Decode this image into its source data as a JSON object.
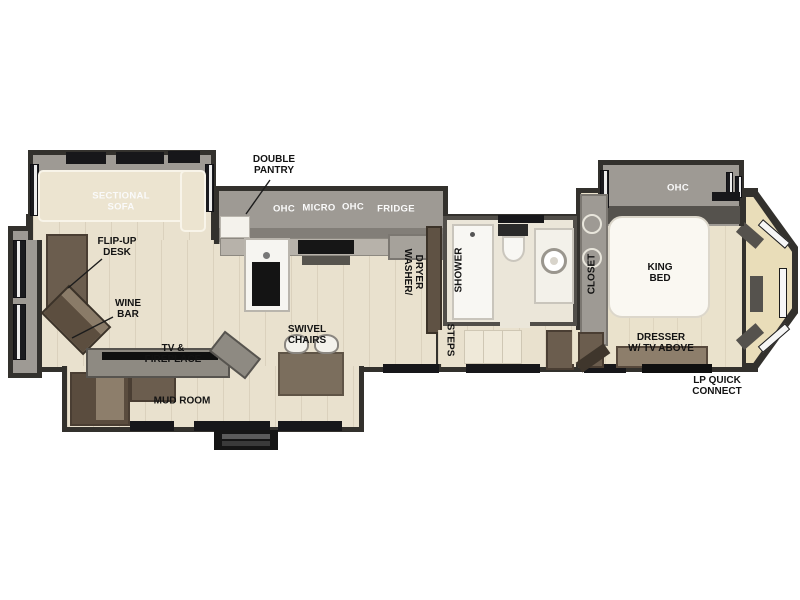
{
  "colors": {
    "wall": "#33312d",
    "wall_fill": "#9e9a94",
    "floor": "#e9e1ce",
    "bedroom_floor": "#eae2cc",
    "cabinet_brown": "#6b5d4e",
    "counter_white": "#f6f5f1",
    "window_dark": "#17171a",
    "label_dark": "#131313",
    "label_light": "#fafafa"
  },
  "living": {
    "sectional_sofa_label": "SECTIONAL\nSOFA",
    "flip_up_desk_label": "FLIP-UP\nDESK",
    "wine_bar_label": "WINE\nBAR",
    "tv_fireplace_label": "TV &\nFIREPLACE",
    "mud_room_label": "MUD ROOM",
    "swivel_chairs_label": "SWIVEL\nCHAIRS"
  },
  "kitchen": {
    "double_pantry_label": "DOUBLE\nPANTRY",
    "ohc_left_label": "OHC",
    "micro_label": "MICRO",
    "ohc_right_label": "OHC",
    "fridge_label": "FRIDGE"
  },
  "bath": {
    "washer_dryer_label": "WASHER/\nDRYER",
    "shower_label": "SHOWER",
    "steps_label": "STEPS"
  },
  "bedroom": {
    "ohc_label": "OHC",
    "closet_label": "CLOSET",
    "king_bed_label": "KING\nBED",
    "dresser_label": "DRESSER\nW/ TV ABOVE",
    "lp_quick_connect_label": "LP QUICK\nCONNECT"
  }
}
